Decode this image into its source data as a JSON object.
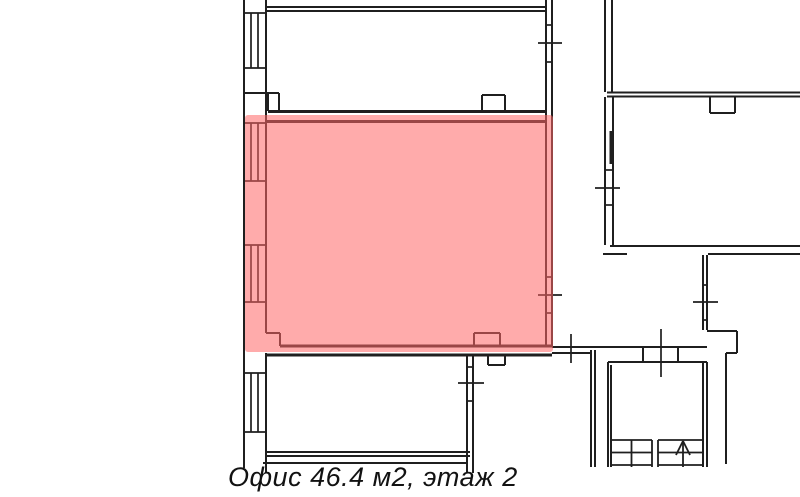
{
  "caption": {
    "text": "Офис 46.4 м2, этаж 2"
  },
  "plan": {
    "background": "#ffffff",
    "stroke_color": "#1f1f1f",
    "highlight": {
      "name": "selected-office-highlight",
      "color": "rgba(255,102,102,0.55)",
      "x": 245,
      "y": 115,
      "width": 308,
      "height": 237,
      "radius": 3
    },
    "groups": [
      {
        "name": "walls",
        "width": 2,
        "segments": [
          [
            244,
            0,
            244,
            468
          ],
          [
            266,
            0,
            266,
            333
          ],
          [
            266,
            353,
            266,
            473
          ],
          [
            244,
            93,
            279,
            93
          ],
          [
            268,
            93,
            268,
            111
          ],
          [
            279,
            93,
            279,
            111
          ],
          [
            266,
            7,
            546,
            7
          ],
          [
            266,
            11,
            546,
            11
          ],
          [
            546,
            0,
            546,
            118
          ],
          [
            552,
            0,
            552,
            118
          ],
          [
            482,
            95,
            482,
            111
          ],
          [
            482,
            95,
            505,
            95
          ],
          [
            505,
            95,
            505,
            111
          ],
          [
            546,
            118,
            546,
            347
          ],
          [
            552,
            118,
            552,
            347
          ],
          [
            266,
            333,
            280,
            333
          ],
          [
            280,
            333,
            280,
            346
          ],
          [
            474,
            333,
            474,
            346
          ],
          [
            474,
            333,
            500,
            333
          ],
          [
            500,
            333,
            500,
            346
          ],
          [
            552,
            347,
            707,
            347
          ],
          [
            552,
            353,
            592,
            353
          ],
          [
            643,
            347,
            643,
            362
          ],
          [
            678,
            347,
            678,
            362
          ],
          [
            591,
            350,
            591,
            467
          ],
          [
            595,
            350,
            595,
            467
          ],
          [
            488,
            356,
            488,
            365
          ],
          [
            488,
            365,
            505,
            365
          ],
          [
            505,
            356,
            505,
            365
          ],
          [
            467,
            356,
            467,
            473
          ],
          [
            473,
            356,
            473,
            473
          ],
          [
            267,
            452,
            470,
            452
          ],
          [
            267,
            456,
            470,
            456
          ],
          [
            263,
            463,
            466,
            463
          ],
          [
            605,
            0,
            605,
            92
          ],
          [
            612,
            0,
            612,
            92
          ],
          [
            607,
            92.5,
            800,
            92.5
          ],
          [
            607,
            96.5,
            800,
            96.5
          ],
          [
            710,
            97,
            710,
            113
          ],
          [
            710,
            113,
            735,
            113
          ],
          [
            735,
            97,
            735,
            113
          ],
          [
            605,
            97,
            605,
            245
          ],
          [
            613,
            97,
            613,
            245
          ],
          [
            610,
            246,
            800,
            246
          ],
          [
            603,
            254,
            627,
            254
          ],
          [
            708,
            254,
            800,
            254
          ],
          [
            703,
            255,
            703,
            330
          ],
          [
            707,
            255,
            707,
            330
          ],
          [
            707,
            331,
            737,
            331
          ],
          [
            737,
            331,
            737,
            353
          ],
          [
            726,
            353,
            737,
            353
          ],
          [
            726,
            353,
            726,
            464
          ],
          [
            608,
            362,
            707,
            362
          ],
          [
            608,
            362,
            608,
            467
          ],
          [
            611,
            365,
            611,
            467
          ],
          [
            703,
            362,
            703,
            467
          ],
          [
            707,
            362,
            707,
            467
          ]
        ]
      },
      {
        "name": "thick-walls",
        "width": 3,
        "segments": [
          [
            268,
            111.5,
            546,
            111.5
          ],
          [
            266,
            121.5,
            546,
            121.5
          ],
          [
            280,
            346,
            552,
            346
          ],
          [
            266,
            355,
            552,
            355
          ],
          [
            611,
            131,
            611,
            164
          ]
        ]
      },
      {
        "name": "window-glyphs",
        "width": 1.7,
        "segments": [
          [
            244,
            13,
            266,
            13
          ],
          [
            244,
            68,
            266,
            68
          ],
          [
            251,
            13,
            251,
            68
          ],
          [
            258,
            13,
            258,
            68
          ],
          [
            244,
            123,
            266,
            123
          ],
          [
            244,
            181,
            266,
            181
          ],
          [
            251,
            123,
            251,
            181
          ],
          [
            258,
            123,
            258,
            181
          ],
          [
            244,
            245,
            266,
            245
          ],
          [
            244,
            302,
            266,
            302
          ],
          [
            251,
            245,
            251,
            302
          ],
          [
            258,
            245,
            258,
            302
          ],
          [
            244,
            373,
            266,
            373
          ],
          [
            244,
            432,
            266,
            432
          ],
          [
            251,
            373,
            251,
            432
          ],
          [
            258,
            373,
            258,
            432
          ],
          [
            546,
            25,
            552,
            25
          ],
          [
            546,
            62,
            552,
            62
          ],
          [
            538,
            43,
            562,
            43
          ],
          [
            546,
            277,
            552,
            277
          ],
          [
            546,
            313,
            552,
            313
          ],
          [
            538,
            295,
            562,
            295
          ],
          [
            605,
            170,
            613,
            170
          ],
          [
            605,
            205,
            613,
            205
          ],
          [
            595,
            188,
            620,
            188
          ],
          [
            703,
            285,
            707,
            285
          ],
          [
            703,
            320,
            707,
            320
          ],
          [
            693,
            302,
            718,
            302
          ],
          [
            467,
            367,
            473,
            367
          ],
          [
            467,
            401,
            473,
            401
          ],
          [
            458,
            383,
            484,
            383
          ],
          [
            571,
            334,
            571,
            363
          ],
          [
            661,
            329,
            661,
            377
          ]
        ]
      },
      {
        "name": "stairs",
        "width": 1.8,
        "segments": [
          [
            611,
            440,
            652,
            440
          ],
          [
            611,
            452.5,
            652,
            452.5
          ],
          [
            611,
            465,
            652,
            465
          ],
          [
            631.5,
            440,
            631.5,
            467
          ],
          [
            652,
            440,
            652,
            467
          ],
          [
            658,
            440,
            658,
            467
          ],
          [
            658,
            440,
            703,
            440
          ],
          [
            658,
            452.5,
            703,
            452.5
          ],
          [
            658,
            465,
            703,
            465
          ]
        ]
      },
      {
        "name": "stairs-direction-arrow",
        "width": 1.8,
        "segments": [
          [
            683,
            441,
            683,
            467
          ],
          [
            683,
            441,
            676,
            455
          ],
          [
            683,
            441,
            690,
            455
          ]
        ]
      }
    ]
  }
}
